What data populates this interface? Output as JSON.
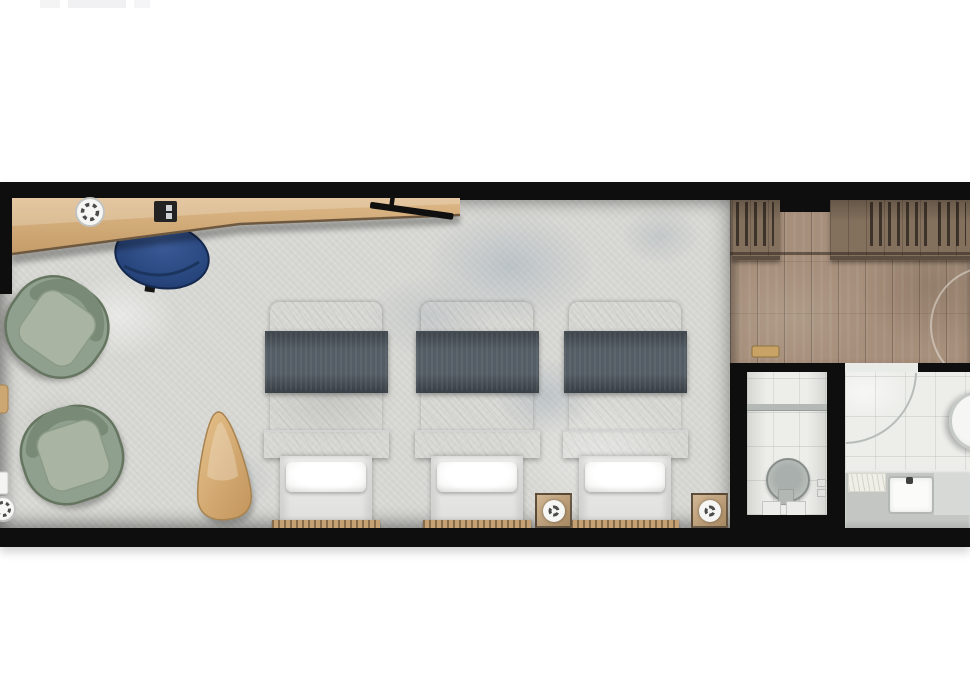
{
  "page": {
    "kind": "architectural floor plan rendering",
    "description": "Top-down rendered floor plan of a long hotel guest room with three single beds, a desk nook, lounge chairs, wardrobe entry corridor and bathroom",
    "visible_text": "",
    "artifact": "faint cropped logo remnant at top-left edge"
  },
  "palette": {
    "wall": "#0e0e0e",
    "carpet": "#d8d8d4",
    "carpet_accent": "#9db0c1",
    "desk_wood": "#cfa873",
    "floor_wood": "#a68f7b",
    "wardrobe_wood": "#83705d",
    "navy": "#2a4677",
    "sage": "#93a392",
    "sage_dark": "#687866",
    "slate": "#545d65",
    "bed_white": "#f3f3f2",
    "strip_wood": "#c4a072",
    "tile": "#edeeea",
    "vanity": "#c3c6c2",
    "table_wood": "#d9ae72"
  },
  "plan": {
    "rooms": [
      {
        "id": "bedroom",
        "floor": "mottled gray carpet"
      },
      {
        "id": "entry-closet",
        "floor": "wood planks"
      },
      {
        "id": "wc",
        "floor": "white tile"
      },
      {
        "id": "bathroom",
        "floor": "white tile"
      }
    ],
    "beds": {
      "count": 3
    },
    "furniture": [
      {
        "id": "desk",
        "kind": "angled wood console desk along top wall"
      },
      {
        "id": "desk-chair",
        "kind": "navy half-round chair"
      },
      {
        "id": "desk-light",
        "kind": "round ceiling light symbol"
      },
      {
        "id": "coffee-machine",
        "kind": "black desktop appliance"
      },
      {
        "id": "tv",
        "kind": "angled wall television"
      },
      {
        "id": "armchair-1",
        "kind": "sage round lounge chair"
      },
      {
        "id": "armchair-2",
        "kind": "sage round lounge chair"
      },
      {
        "id": "side-table",
        "kind": "rounded triangle wood table"
      },
      {
        "id": "bed",
        "kind": "single bed with gray throw, white duvet and pillow"
      },
      {
        "id": "bedside-light-1",
        "kind": "wood pad with round light"
      },
      {
        "id": "bedside-light-2",
        "kind": "wood pad with round light"
      },
      {
        "id": "corner-light",
        "kind": "round light symbol, bottom-left"
      },
      {
        "id": "wardrobe",
        "kind": "open closet with hanging clothes"
      },
      {
        "id": "entry-door-arc",
        "kind": "door swing on wood floor"
      },
      {
        "id": "bath-door-arc",
        "kind": "door swing into bathroom"
      },
      {
        "id": "toilet",
        "kind": "round toilet in WC"
      },
      {
        "id": "vanity",
        "kind": "counter with rectangular sink"
      },
      {
        "id": "round-basin",
        "kind": "round basin at right edge"
      },
      {
        "id": "bath-mat",
        "kind": "small mat on vanity"
      }
    ]
  }
}
